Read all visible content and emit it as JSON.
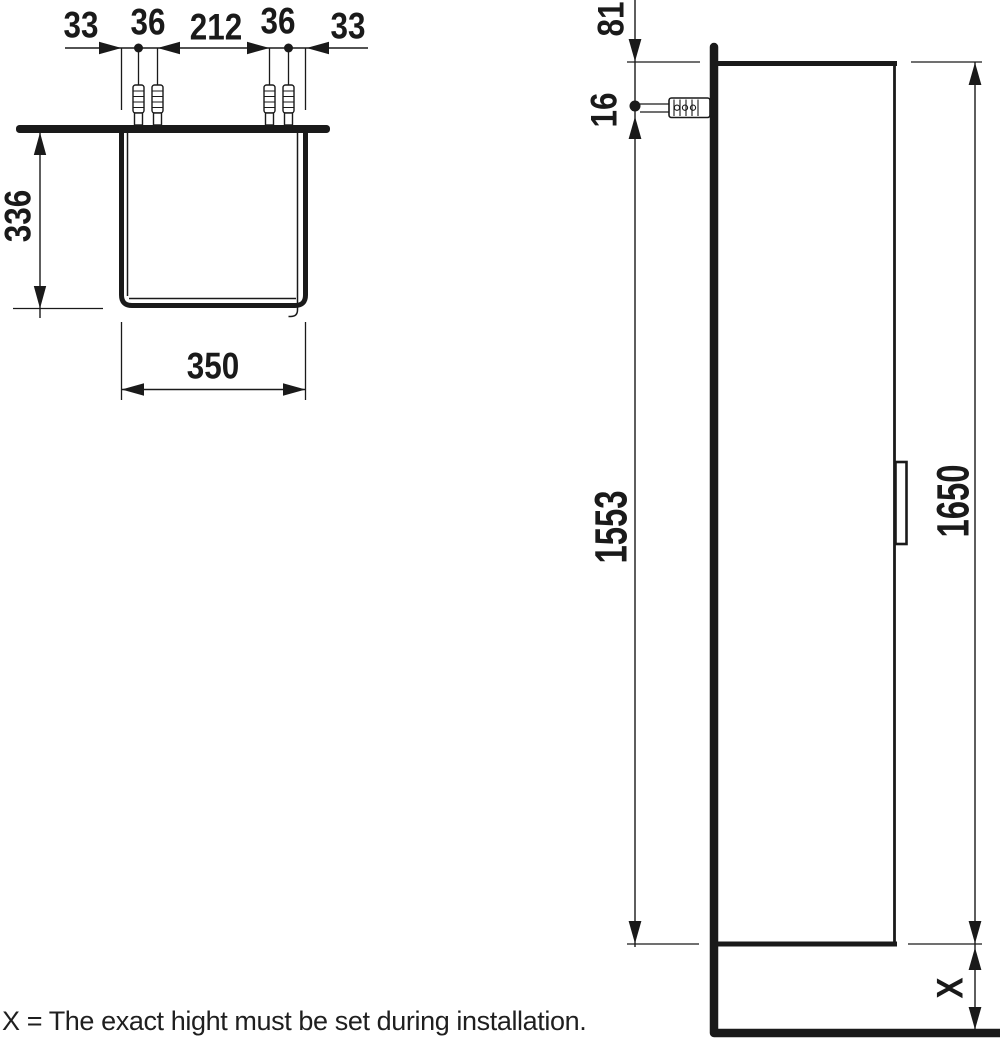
{
  "note": "X = The exact hight must be set during installation.",
  "top_view": {
    "dim_left_edge": "33",
    "dim_anchor_pair_left": "36",
    "dim_anchor_spacing": "212",
    "dim_anchor_pair_right": "36",
    "dim_right_edge": "33",
    "dim_depth": "336",
    "dim_width": "350"
  },
  "side_view": {
    "dim_top_to_anchor": "81",
    "dim_anchor_offset": "16",
    "dim_anchor_to_bottom": "1553",
    "dim_height": "1650",
    "dim_bottom_clearance": "X"
  },
  "colors": {
    "ink": "#1a1a1a",
    "background": "#ffffff"
  }
}
